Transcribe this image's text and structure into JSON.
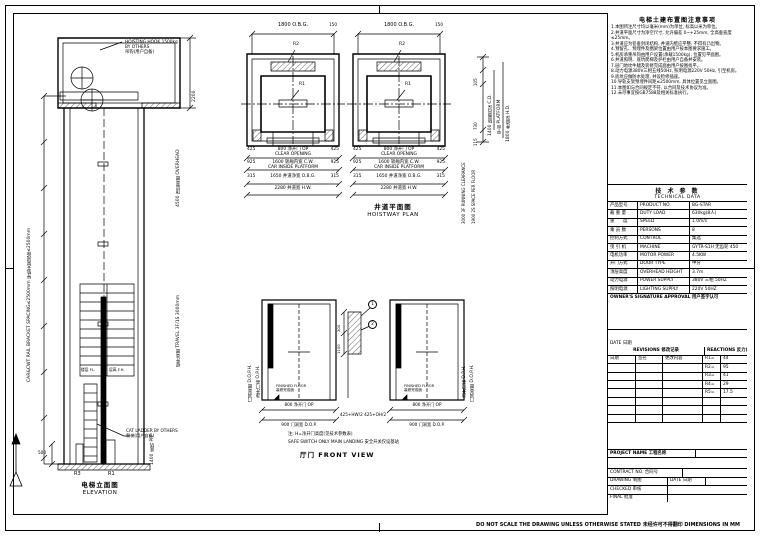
{
  "page": {
    "bottom_note": "DO NOT SCALE THE DRAWING UNLESS OTHERWISE STATED 未经许可不得翻印 DIMENSIONS IN MM",
    "line_color": "#000000",
    "bg_color": "#ffffff"
  },
  "elevation": {
    "caption_cn": "电梯立面图",
    "caption_en": "ELEVATION",
    "hook_note_1": "HOISTING HOOK 1500kg",
    "hook_note_2": "BY OTHERS",
    "hook_note_3": "吊钩(用户自备)",
    "bracket_note": "CAR&CWT RAIL BRACKET SPACING≤2500mm 导轨支架间距≤2500mm",
    "mrh_dim": "2200",
    "overhead_label": "4500 顶层高度 OVERHEAD",
    "travel_label": "提升高度 TRAVEL 3F/1S 3000mm",
    "cat_ladder_note_1": "CAT LADDER BY OTHERS",
    "cat_ladder_note_2": "爬梯(用户自备)",
    "pit_label": "1400 底坑 PIT",
    "dim_500": "500",
    "r3": "R3",
    "r1": "R1",
    "sched_fl": "楼层 FL.",
    "sched_fh": "层高 F.H."
  },
  "plan": {
    "caption_cn": "井道平面图",
    "caption_en": "HOISTWAY PLAN",
    "obg": "1800 O.B.G.",
    "dim150": "150",
    "r1": "R1",
    "r2": "R2",
    "d425": "425",
    "d925": "925",
    "d315": "315",
    "op_cn": "800 净开门 OP",
    "op_en": "CLEAR OPENING",
    "cw_cn": "1600 轿厢内宽 C.W.",
    "cw_en": "CAR INSIDE PLATFORM",
    "obg_row": "1650 井道净宽 O.B.G.",
    "hw_row": "2280 井道宽 H.W.",
    "cd_label": "1400 轿厢内深 C.D.",
    "plat_label": "平台 PLATFORM",
    "hd_label": "1800 井道深 H.D.",
    "chain_1": "105",
    "chain_2": "730",
    "chain_3": "115",
    "note_clearance": "3000 3F RUNNING CLEARANCE",
    "note_space": "1900 2S SPACE PER FLOOR"
  },
  "front": {
    "caption": "厅门 FRONT VIEW",
    "oph_label": "门洞高度 D.O.P.H.",
    "op_label": "净开门高 O.P.H.",
    "ff1": "FINISHED FLOOR",
    "ff2": "装修完成面",
    "center_dim": "425+HW/2   425+OH/2",
    "d300": "300",
    "d1100": "1100",
    "c1": "1",
    "c2": "2",
    "op_row_cn": "800 净开门 OP",
    "op_row_en": "CLEAR OPENING",
    "dw_row": "900 门洞宽 D.O.P.",
    "note1": "注: H=净开门高度(见技术参数表)",
    "note2": "SAFE SWITCH ONLY MAIN LANDING 安全开关仅设基站"
  },
  "notes_panel": {
    "title": "电梯土建布置图注意事项",
    "items": [
      "1.本图所注尺寸均以毫米(mm)为单位, 标高以米为单位。",
      "2.井道平面尺寸为净空尺寸, 允许偏差 0~+25mm, 全高垂直度≤25mm。",
      "3.井道应为铅垂封闭结构, 井道内壁应平整, 不得有凸出物。",
      "4.预留孔、预埋件及圈梁位置由用户按本图要求施工。",
      "5.机房承重吊钩由用户设置(承载1500kg), 位置见平面图。",
      "6.井道照明、底坑爬梯及护栏由用户自备并安装。",
      "7.层门地坎牛腿及装修完成面由用户按图找平。",
      "8.动力电源380V三相五线50Hz, 照明电源220V 50Hz, 引至机房。",
      "9.底坑应做防水处理, 并设检修插座。",
      "10.导轨支架预埋件间距≤2500mm, 具体位置见立面图。",
      "11.本图如与合同规定不符, 以合同及技术协议为准。",
      "12.未尽事宜按GB7588及相关标准执行。"
    ]
  },
  "tech_table": {
    "title_cn": "技 术 参 数",
    "title_en": "TECHNICAL DATA",
    "rows": [
      {
        "cn": "产品型号",
        "en": "PRODUCT NO.",
        "val": "BG-STAR"
      },
      {
        "cn": "载 重 量",
        "en": "DUTY LOAD",
        "val": "630kg(8人)"
      },
      {
        "cn": "速　　度",
        "en": "SPEED",
        "val": "1.0m/s"
      },
      {
        "cn": "乘 员 数",
        "en": "PERSONS",
        "val": "8"
      },
      {
        "cn": "控制方式",
        "en": "CONTROL",
        "val": "集选"
      },
      {
        "cn": "曳 引 机",
        "en": "MACHINE",
        "val": "GYTR-S1H 无齿轮 450"
      },
      {
        "cn": "电机功率",
        "en": "MOTOR POWER",
        "val": "4.5KW"
      },
      {
        "cn": "开门方式",
        "en": "DOOR TYPE",
        "val": "中分"
      },
      {
        "cn": "顶层高度",
        "en": "OVERHEAD HEIGHT",
        "val": "3.7m"
      },
      {
        "cn": "动力电源",
        "en": "POWER SUPPLY",
        "val": "380V 三相 50HZ"
      },
      {
        "cn": "照明电源",
        "en": "LIGHTING SUPPLY",
        "val": "220V 50HZ"
      }
    ],
    "footer": "OWNER'S SIGNATURE APPROVAL 用户签字认可"
  },
  "revision": {
    "date_label": "DATE 日期",
    "rev_header": "REVISIONS 修改记录",
    "react_header": "REACTIONS 反力(KN)",
    "col_date": "日期",
    "col_name": "签名",
    "col_changed": "更改内容",
    "reactions": [
      {
        "k": "R1=",
        "v": "44"
      },
      {
        "k": "R2=",
        "v": "95"
      },
      {
        "k": "R3=",
        "v": "41"
      },
      {
        "k": "R4=",
        "v": "29"
      },
      {
        "k": "R5=",
        "v": "17.5"
      }
    ]
  },
  "title_block": {
    "project": "PROJECT NAME 工程名称",
    "contract": "CONTRACT NO. 合同号",
    "drawing": "DRAWING 制图",
    "date": "DATE 日期",
    "checked": "CHECKED 审核",
    "final": "FINAL 批准"
  }
}
